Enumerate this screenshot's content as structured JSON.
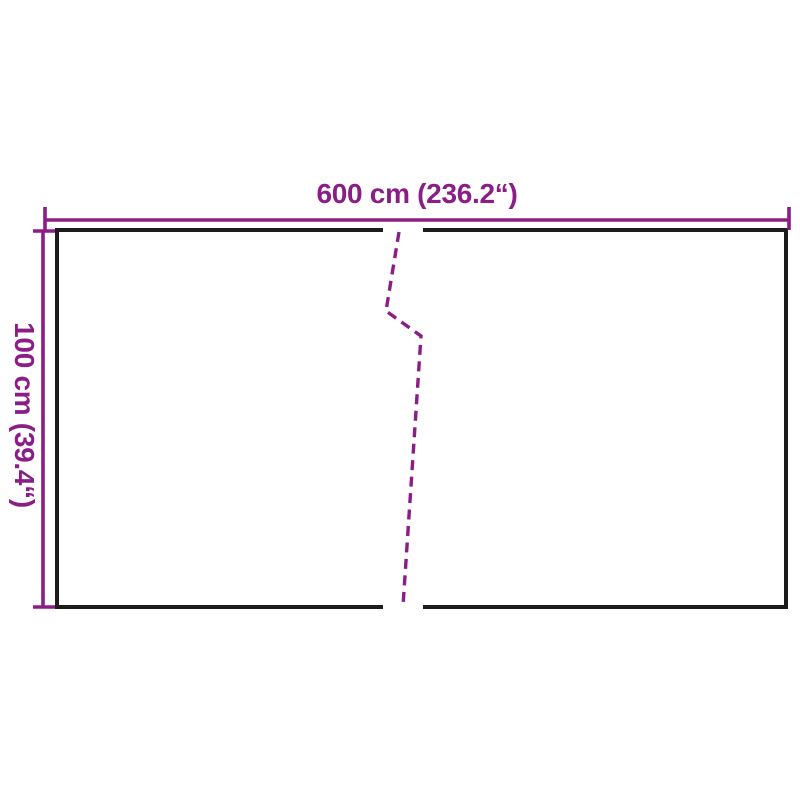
{
  "diagram": {
    "title": "balcony-screen-dimension-diagram",
    "width_label": "600 cm (236.2“)",
    "height_label": "100 cm (39.4“)",
    "colors": {
      "dimension_accent": "#8B1D86",
      "outline": "#1C1C1C",
      "background": "#FFFFFF"
    }
  }
}
